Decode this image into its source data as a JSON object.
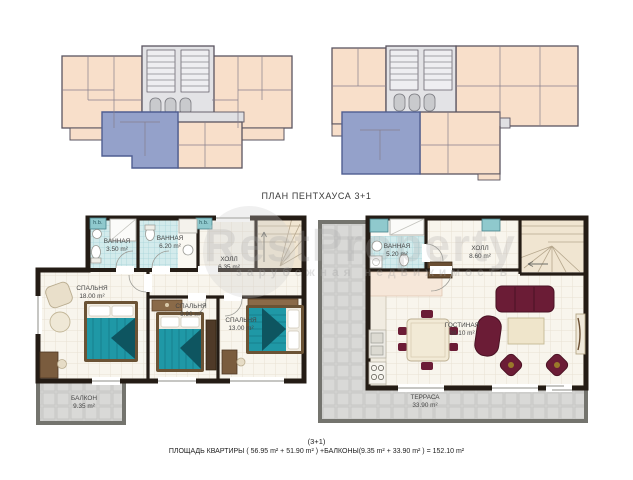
{
  "title": "ПЛАН ПЕНТХАУСА 3+1",
  "watermark": {
    "brand": "RestProperty",
    "tagline": "зарубежная недвижимость"
  },
  "plans": {
    "floor1": {
      "hb_label": "h.b.",
      "rooms": [
        {
          "label": "ВАННАЯ",
          "area": "3.50 m²"
        },
        {
          "label": "ВАННАЯ",
          "area": "6.20 m²"
        },
        {
          "label": "ХОЛЛ",
          "area": "6.35 m²"
        },
        {
          "label": "СПАЛЬНЯ",
          "area": "18.00 m²"
        },
        {
          "label": "СПАЛЬНЯ",
          "area": "9.90 m²"
        },
        {
          "label": "СПАЛЬНЯ",
          "area": "13.00 m²"
        },
        {
          "label": "БАЛКОН",
          "area": "9.35 m²"
        }
      ]
    },
    "floor2": {
      "rooms": [
        {
          "label": "ВАННАЯ",
          "area": "5.20 m²"
        },
        {
          "label": "ХОЛЛ",
          "area": "8.60 m²"
        },
        {
          "label": "ГОСТИНАЯ",
          "area": "38.10 m²"
        },
        {
          "label": "ТЕРРАСА",
          "area": "33.90 m²"
        }
      ]
    }
  },
  "caption": {
    "line1": "(3+1)",
    "line2": "ПЛОЩАДЬ КВАРТИРЫ ( 56.95 m² + 51.90 m² ) +БАЛКОНЫ(9.35 m² + 33.90 m² ) = 152.10 m²"
  },
  "colors": {
    "wall": "#241c15",
    "keyplan_room": "#f8dfca",
    "highlight_unit": "#94a1ca",
    "bath_tile": "#d3ebec",
    "terrace_tile": "#d4d4d2",
    "bed_teal": "#1f98a6",
    "furniture_maroon": "#6b1c36"
  }
}
